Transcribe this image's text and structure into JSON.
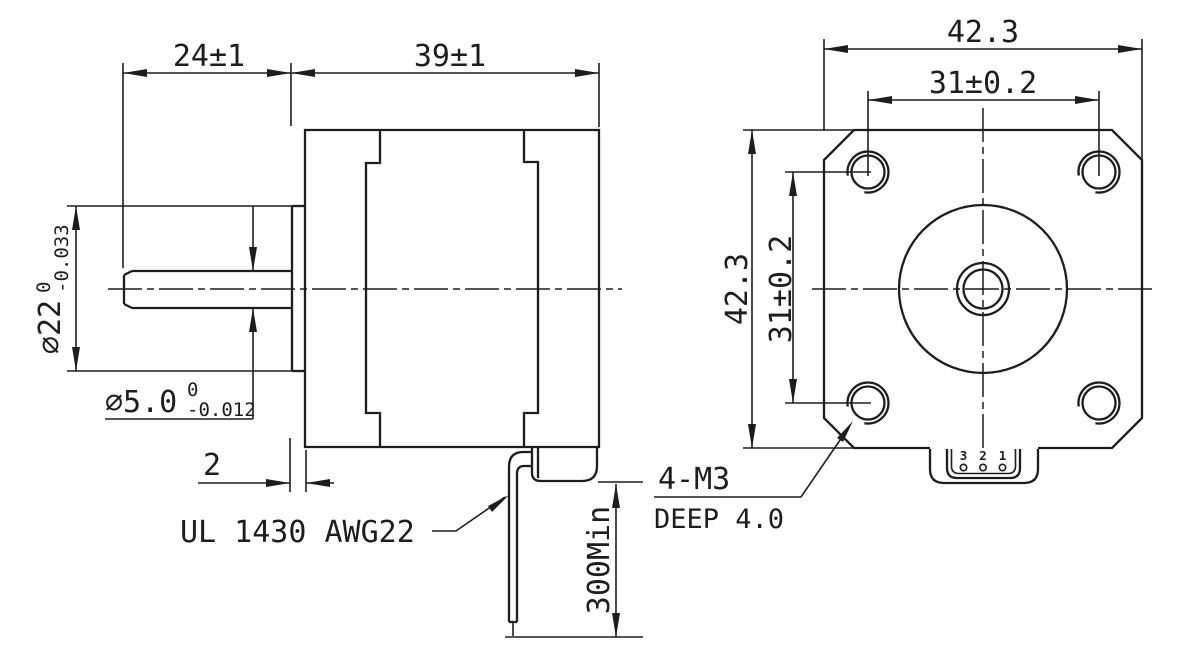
{
  "side_view": {
    "dim_shaft_section": "24±1",
    "dim_body_length": "39±1",
    "pilot_dia": {
      "main": "⌀22",
      "tol_upper": "0",
      "tol_lower": "-0.033"
    },
    "shaft_dia": {
      "main": "⌀5.0",
      "tol_upper": "0",
      "tol_lower": "-0.012"
    },
    "dim_boss_thickness": "2",
    "wire_label": "UL 1430 AWG22",
    "dim_lead_length": "300Min"
  },
  "front_view": {
    "dim_width": "42.3",
    "dim_height": "42.3",
    "dim_hole_pitch_h": "31±0.2",
    "dim_hole_pitch_v": "31±0.2",
    "mounting_note_line1": "4-M3",
    "mounting_note_line2": "DEEP 4.0",
    "connector_pins": [
      "3",
      "2",
      "1"
    ]
  },
  "colors": {
    "line": "#1d1d1d",
    "background": "#ffffff"
  }
}
